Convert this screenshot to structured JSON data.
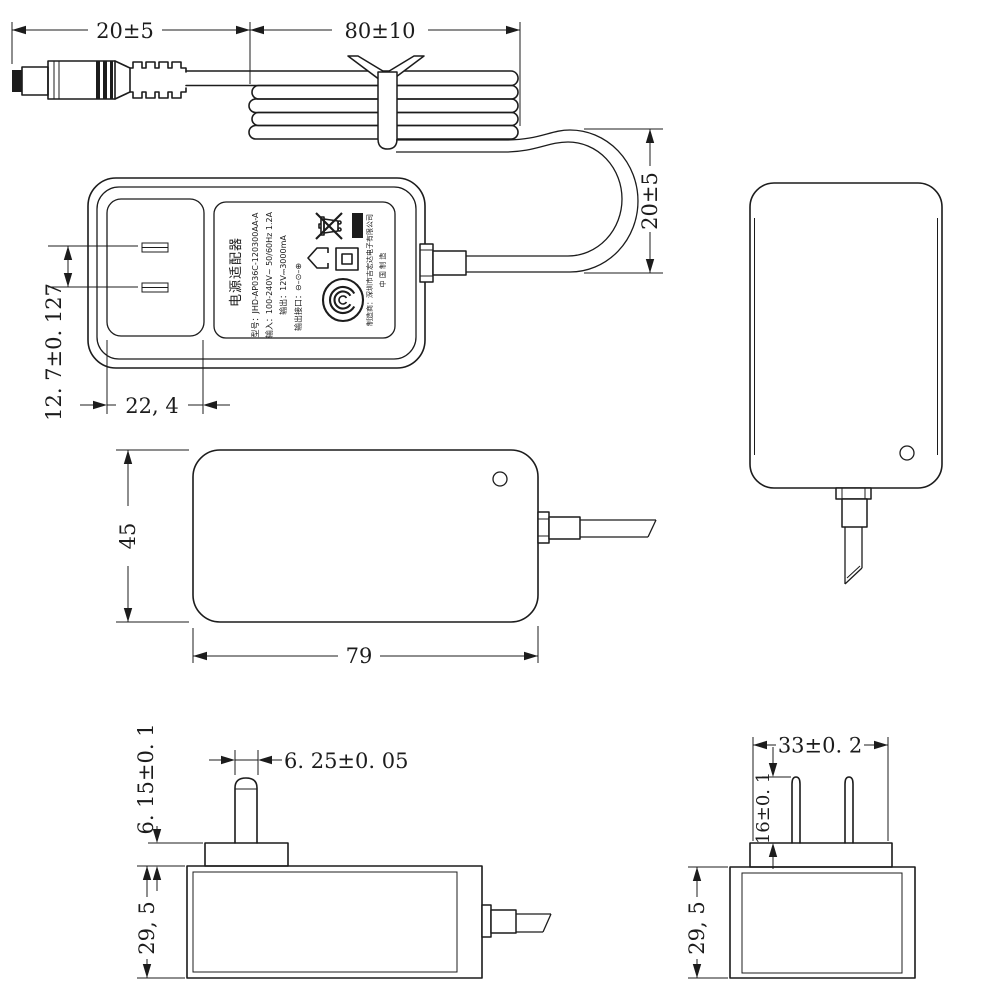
{
  "colors": {
    "background": "#ffffff",
    "line": "#1c1c1c"
  },
  "dimensions": {
    "plug_cable_length": "20±5",
    "coil_length": "80±10",
    "loop_height": "20±5",
    "blade_spacing": "12. 7±0. 127",
    "plug_face_width": "22, 4",
    "body_height": "45",
    "body_length": "79",
    "boss_height": "6. 15±0. 1",
    "pin_width": "6. 25±0. 05",
    "body_depth_side": "29, 5",
    "boss_width": "33±0. 2",
    "pin_length": "16±0. 1",
    "body_depth_end": "29, 5"
  },
  "label": {
    "title": "电源适配器",
    "model": "型号：JHD-AP036C-120300AA-A",
    "input": "输入：100-240V~ 50/60Hz 1.2A",
    "output": "输出：12V⎓3000mA",
    "output_port": "输出接口：⊖–⊙–⊕",
    "manufacturer": "制造商：深圳市吉宏达电子有限公司",
    "made_in": "中 国 制 造",
    "icons": [
      "weee-bin-icon",
      "indoor-use-icon",
      "class-ii-icon",
      "ccc-mark-icon"
    ]
  }
}
